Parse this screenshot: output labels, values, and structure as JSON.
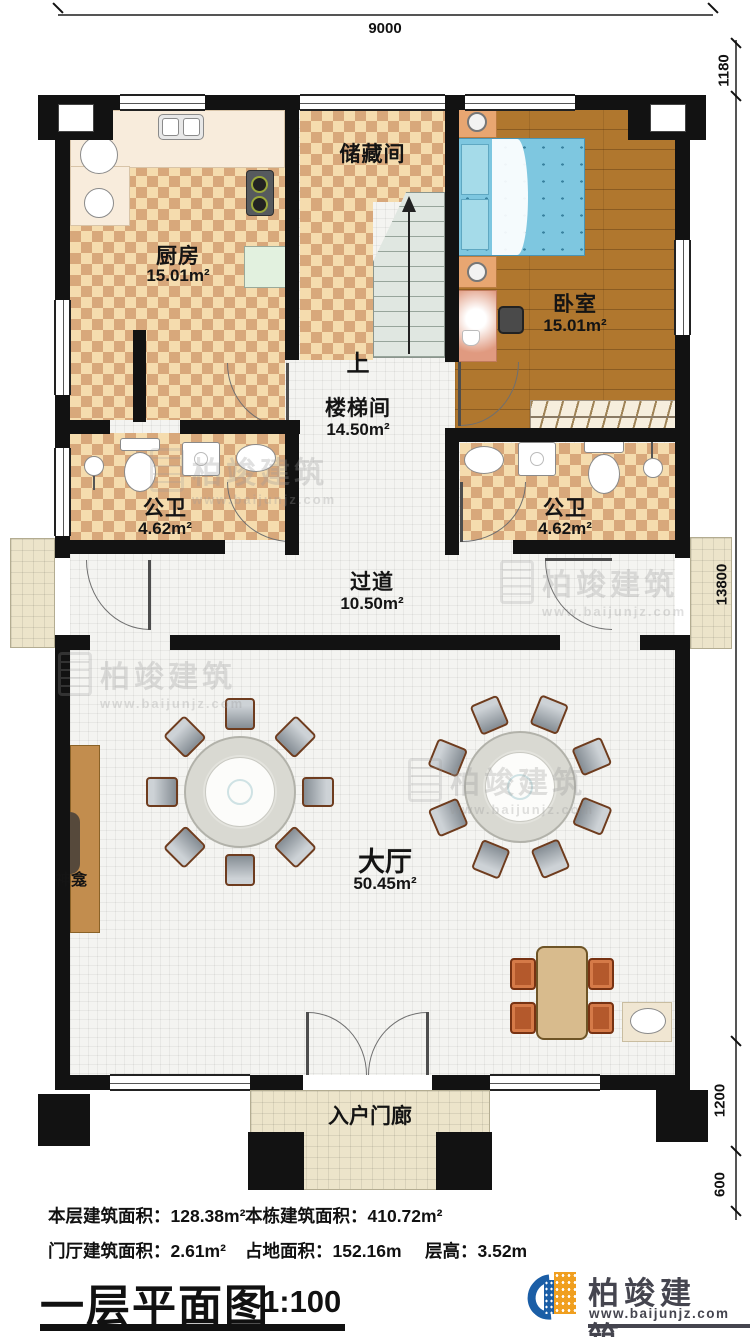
{
  "title": {
    "text": "一层平面图",
    "scale": "1:100"
  },
  "brand": {
    "name": "柏竣建筑",
    "website": "www.baijunjz.com"
  },
  "dimensions": {
    "top": "9000",
    "right_top": "1180",
    "right_middle": "13800",
    "right_lower": "1200",
    "right_bottom": "600"
  },
  "rooms": {
    "kitchen": {
      "name": "厨房",
      "area": "15.01m²"
    },
    "storage": {
      "name": "储藏间"
    },
    "bedroom": {
      "name": "卧室",
      "area": "15.01m²"
    },
    "stairwell": {
      "name": "楼梯间",
      "area": "14.50m²"
    },
    "bath_left": {
      "name": "公卫",
      "area": "4.62m²"
    },
    "bath_right": {
      "name": "公卫",
      "area": "4.62m²"
    },
    "corridor": {
      "name": "过道",
      "area": "10.50m²"
    },
    "hall": {
      "name": "大厅",
      "area": "50.45m²"
    },
    "shrine": {
      "name": "神龛"
    },
    "porch": {
      "name": "入户门廊"
    }
  },
  "stair": {
    "up": "上"
  },
  "stats": {
    "floor_area_label": "本层建筑面积：",
    "floor_area_value": "128.38m²",
    "building_area_label": "本栋建筑面积：",
    "building_area_value": "410.72m²",
    "foyer_area_label": "门厅建筑面积：",
    "foyer_area_value": "2.61m²",
    "land_area_label": "占地面积：",
    "land_area_value": "152.16m",
    "story_height_label": "层高：",
    "story_height_value": "3.52m"
  },
  "colors": {
    "wall": "#121212",
    "checker_light": "#f5dcae",
    "checker_dark": "#d8a87b",
    "wood_floor": "#b0772e",
    "bed_blue": "#7ec7e0",
    "porch_slab": "#ece4ca",
    "logo_blue": "#1b5ea6",
    "logo_orange": "#f09f1f"
  }
}
